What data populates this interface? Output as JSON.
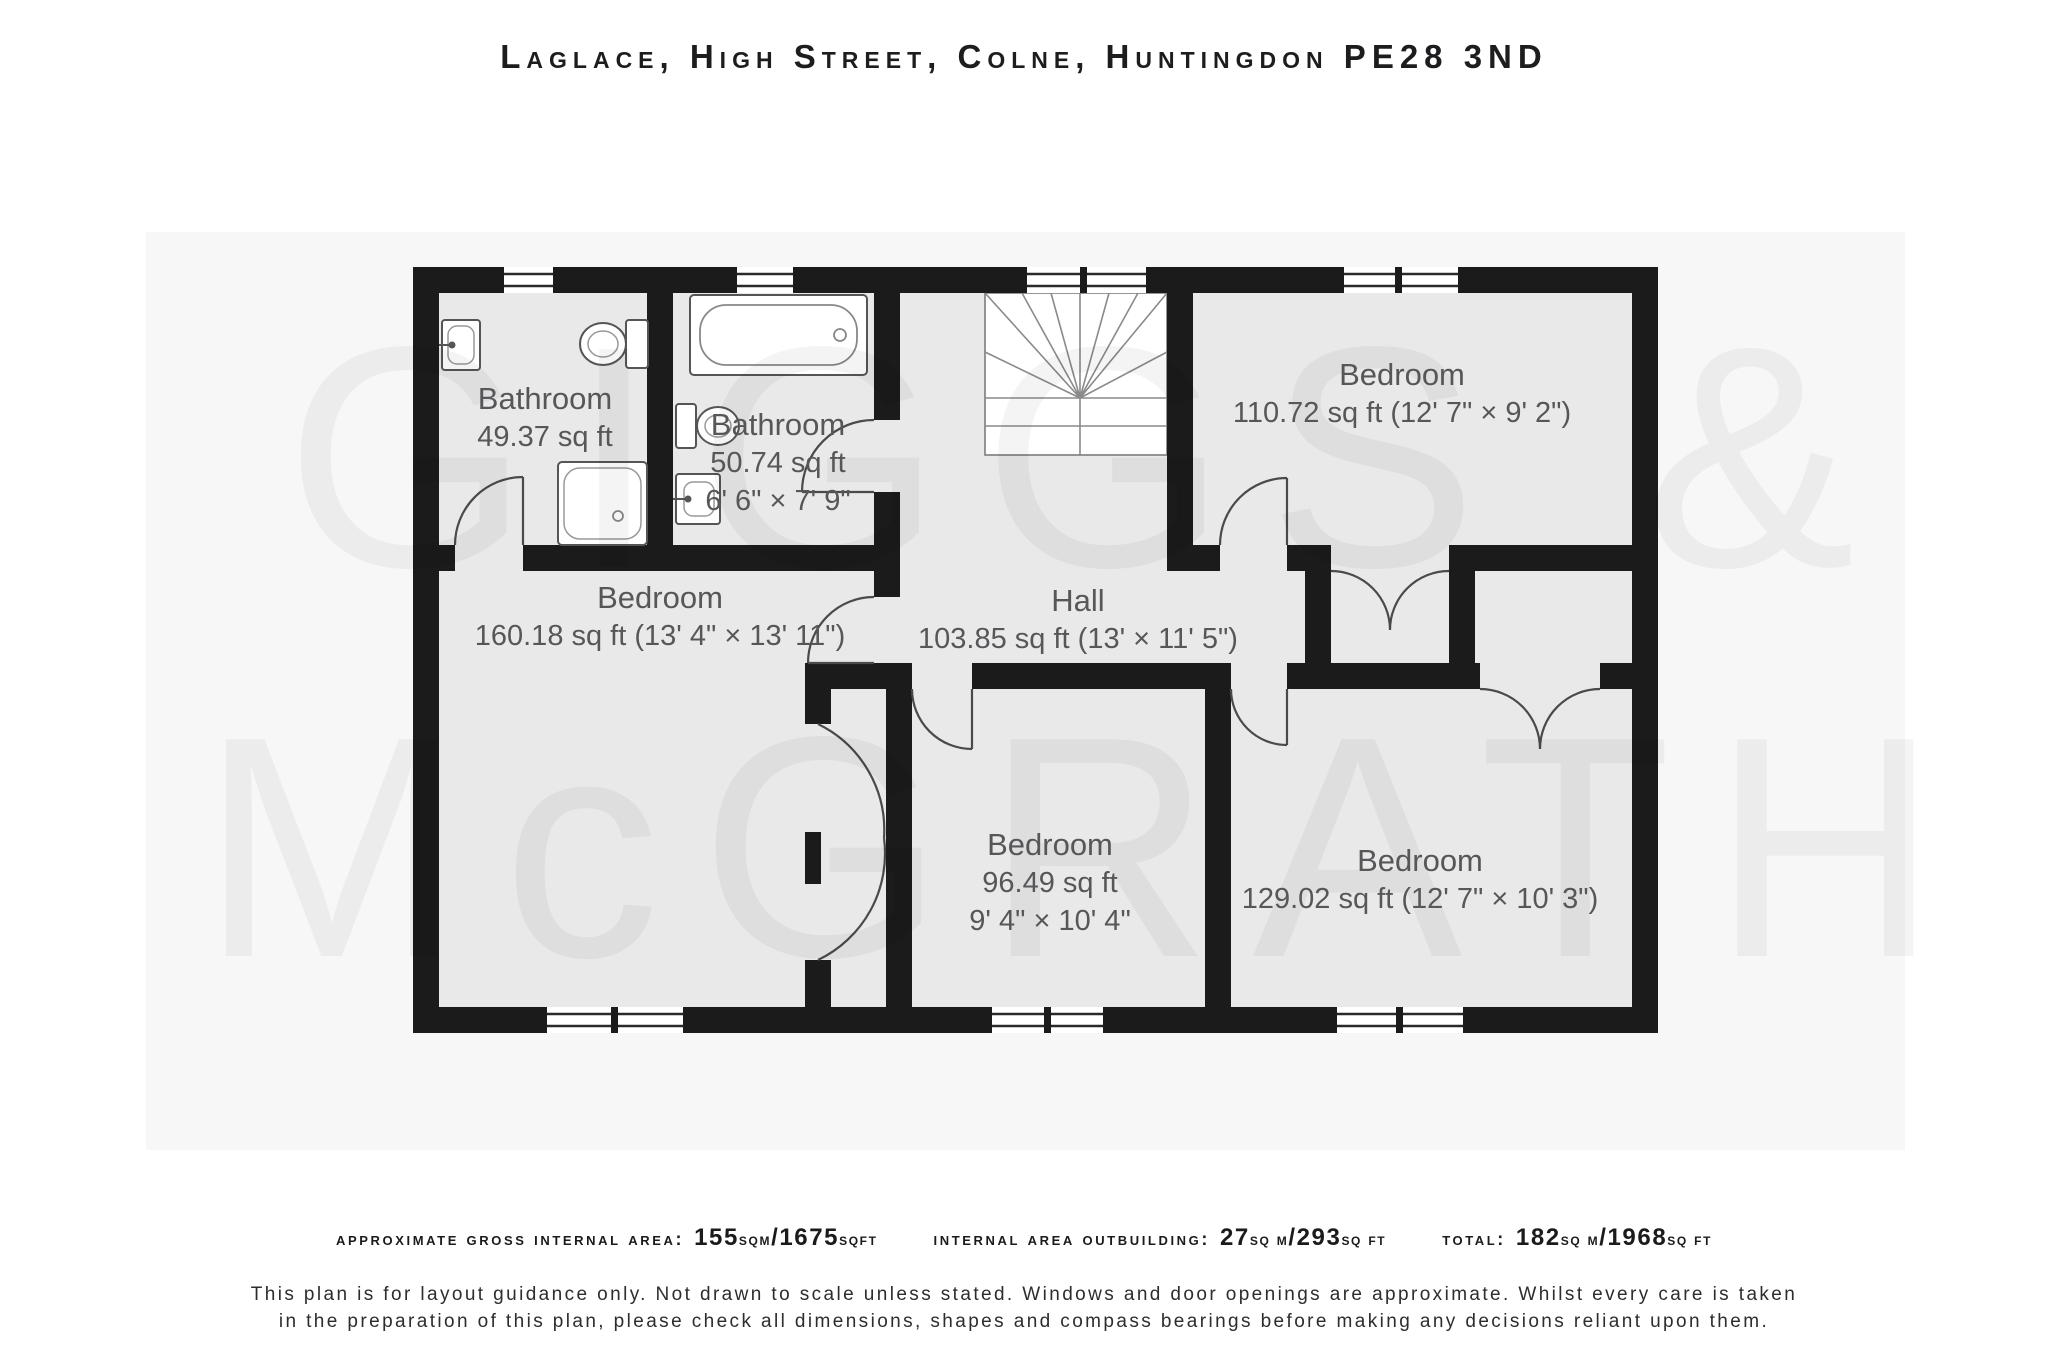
{
  "title": "Laglace, High Street, Colne, Huntingdon PE28 3ND",
  "watermark": {
    "line1": "GIGGS &",
    "line2": "McGRATH"
  },
  "rooms": [
    {
      "id": "bathroom-1",
      "name": "Bathroom",
      "area": "49.37 sq ft",
      "dims": ""
    },
    {
      "id": "bathroom-2",
      "name": "Bathroom",
      "area": "50.74 sq ft",
      "dims": "6' 6\" × 7' 9\""
    },
    {
      "id": "bedroom-top-right",
      "name": "Bedroom",
      "area": "110.72 sq ft (12' 7\" × 9' 2\")",
      "dims": ""
    },
    {
      "id": "bedroom-left",
      "name": "Bedroom",
      "area": "160.18 sq ft (13' 4\" × 13' 11\")",
      "dims": ""
    },
    {
      "id": "hall",
      "name": "Hall",
      "area": "103.85 sq ft (13' × 11' 5\")",
      "dims": ""
    },
    {
      "id": "bedroom-middle",
      "name": "Bedroom",
      "area": "96.49 sq ft",
      "dims": "9' 4\" × 10' 4\""
    },
    {
      "id": "bedroom-bottom-right",
      "name": "Bedroom",
      "area": "129.02 sq ft (12' 7\" × 10' 3\")",
      "dims": ""
    }
  ],
  "footer": {
    "areas": [
      {
        "label": "approximate gross internal area:",
        "big1": "155",
        "small1": "sqm",
        "big2": "/1675",
        "small2": "sqft"
      },
      {
        "label": "internal area outbuilding:",
        "big1": "27",
        "small1": "sq m",
        "big2": "/293",
        "small2": "sq ft"
      },
      {
        "label": "total:",
        "big1": "182",
        "small1": "sq m",
        "big2": "/1968",
        "small2": "sq ft"
      }
    ],
    "disclaimer1": "This plan is for layout guidance only. Not drawn to scale unless stated. Windows and door openings are approximate. Whilst every care is taken",
    "disclaimer2": "in the preparation of this plan, please check all dimensions, shapes and compass bearings before making any decisions reliant upon them."
  }
}
